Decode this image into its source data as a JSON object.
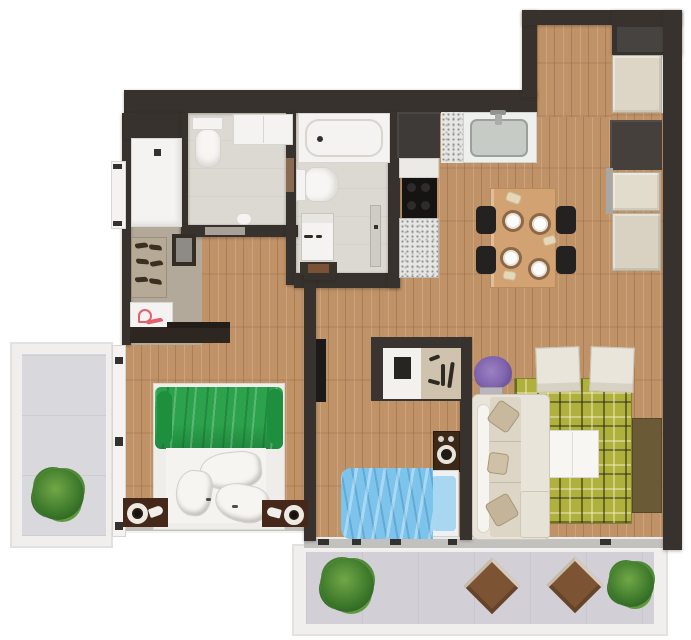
{
  "app": {
    "title": "Apartment Floor Plan",
    "view": "2D top-down furnished floor plan render",
    "canvas_px": "691 x 640"
  },
  "palette": {
    "background": "#ffffff",
    "walls": "#37322d",
    "wood_floor": "#c09268",
    "hall_floor": "#b3a99b",
    "bath_floor": "#dcd9d2",
    "balcony_floor": "#d9d8dc",
    "terrace_floor": "#d2d0d6",
    "rug_green": "#b0b03c",
    "bed_green": "#2ca24c",
    "bed_blue": "#7cc4ec",
    "sofa_cream": "#e9e4d9",
    "closet_cream": "#ddd6c6",
    "closet_dark": "#45403c",
    "plant_green": "#3f7b2c",
    "lavender_purple": "#7f63ad",
    "dining_table_wood": "#d2a273",
    "terrace_table_brown": "#7c5434"
  },
  "rooms": [
    {
      "label": "Entry hall",
      "furniture": [
        "entrance door",
        "wardrobe",
        "shoe rack",
        "shoe art box",
        "stool",
        "dark console"
      ]
    },
    {
      "label": "Bathroom",
      "furniture": [
        "toilet",
        "vanity counter",
        "towel shelf",
        "paper holder"
      ]
    },
    {
      "label": "Bathroom 2 / laundry",
      "furniture": [
        "bathtub",
        "toilet",
        "washing machine",
        "bath bench",
        "door leaf"
      ]
    },
    {
      "label": "Kitchen",
      "furniture": [
        "tall dark cabinet",
        "fridge",
        "black cooktop",
        "stone counter",
        "double sink"
      ]
    },
    {
      "label": "Dining area",
      "furniture": [
        "wood dining table",
        "4 black chairs",
        "4 place settings"
      ]
    },
    {
      "label": "Closet wall",
      "furniture": [
        "3 cream closet modules",
        "1 dark closet module"
      ]
    },
    {
      "label": "Bedroom",
      "furniture": [
        "double bed with green duvet",
        "white sheets and pillows",
        "2 dark nightstands",
        "2 round lamps",
        "balcony sliding door"
      ]
    },
    {
      "label": "Study / second bedroom",
      "furniture": [
        "desk nook with monitor",
        "shelf decor",
        "floor speaker",
        "single bed with blue duvet",
        "wall TV"
      ]
    },
    {
      "label": "Living room",
      "furniture": [
        "cream L-sofa with chaise",
        "3 throw pillows",
        "white coffee table",
        "2 cream armchairs",
        "green plaid rug",
        "olive media sideboard",
        "lavender plant"
      ]
    },
    {
      "label": "Side balcony",
      "furniture": [
        "potted plant"
      ]
    },
    {
      "label": "Front terrace",
      "furniture": [
        "2 potted plants",
        "2 square brown tables"
      ]
    }
  ],
  "items": {
    "entrance_door": "Entrance door",
    "sliding_door": "Balcony sliding door",
    "wardrobe": "Wardrobe",
    "shoe_rack": "Shoe rack",
    "shoe_box": "Shoe art box",
    "stool": "Stool",
    "console": "Dark console",
    "toilet": "Toilet",
    "vanity": "Vanity counter",
    "towel_shelf": "Towel shelf",
    "paper_holder": "Paper holder",
    "bathtub": "Bathtub",
    "washing_machine": "Washing machine",
    "bath_bench": "Bath bench",
    "bath_door": "Bathroom door leaf",
    "tall_cabinet": "Tall kitchen cabinet",
    "fridge": "Fridge",
    "cooktop": "Cooktop",
    "stone_counter": "Stone counter",
    "sink": "Kitchen sink",
    "dining_table": "Dining table",
    "dining_chair": "Dining chair",
    "plate": "Place setting",
    "closet_module": "Closet module",
    "double_bed": "Double bed",
    "green_duvet": "Green duvet",
    "bed_pillow": "Pillow",
    "nightstand": "Nightstand",
    "lamp": "Lamp",
    "wall_tv": "Wall TV",
    "desk_nook": "Desk nook",
    "monitor": "Monitor",
    "shelf_decor": "Shelf decor",
    "speaker": "Speaker",
    "single_bed": "Single bed",
    "sofa": "Sofa",
    "chaise": "Chaise",
    "throw_pillow": "Throw pillow",
    "coffee_table": "Coffee table",
    "armchair": "Armchair",
    "area_rug": "Area rug",
    "media_sideboard": "Media sideboard",
    "lavender": "Lavender plant",
    "potted_plant": "Potted plant",
    "square_table": "Square table",
    "window": "Window band"
  }
}
